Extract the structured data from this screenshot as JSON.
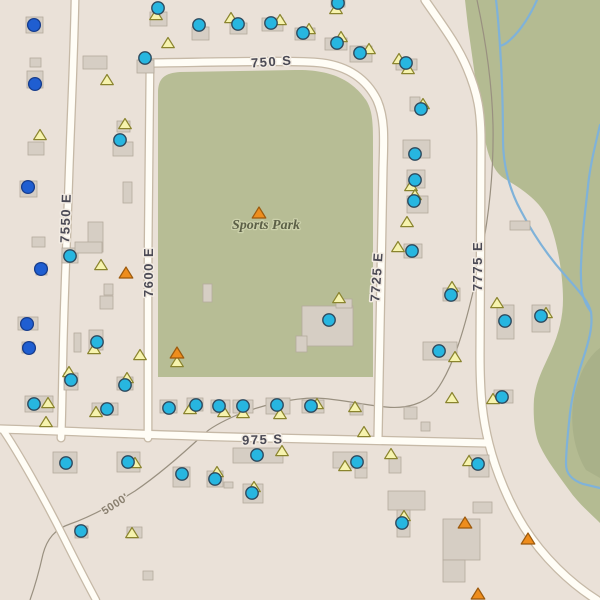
{
  "map_title": "Sports Park area topographic web map",
  "colors": {
    "land": "#eae1d8",
    "veg_green": "#b4bb92",
    "veg_dark": "#a9b189",
    "park_green": "#b7bd95",
    "road_fill": "#fffdf6",
    "road_edge": "#c6b9a7",
    "building_fill": "#d6cec4",
    "building_edge": "#b4aa9d",
    "stream": "#7fb2d9",
    "contour": "#999080",
    "marker_cyan": "#27b6e0",
    "marker_cyan_edge": "#2e4a5e",
    "marker_blue": "#1f5ed1",
    "marker_blue_edge": "#163c8c",
    "tri_yellow": "#f6f3ae",
    "tri_yellow_edge": "#8a842e",
    "tri_orange": "#ee8d1d",
    "tri_orange_edge": "#9c5a0e"
  },
  "labels": {
    "s750": {
      "text": "750 S",
      "transform": "translate(272,66) rotate(-4)"
    },
    "s975": {
      "text": "975 S",
      "transform": "translate(263,444) rotate(-2)"
    },
    "e7550": {
      "text": "7550 E",
      "transform": "translate(70,218) rotate(-88)"
    },
    "e7600": {
      "text": "7600 E",
      "transform": "translate(153,272) rotate(-90)"
    },
    "e7725": {
      "text": "7725 E",
      "transform": "translate(381,277) rotate(-86)"
    },
    "e7775": {
      "text": "7775 E",
      "transform": "translate(482,266) rotate(-90)"
    },
    "park": {
      "text": "Sports Park",
      "transform": "translate(266,229)"
    },
    "contour": {
      "text": "5000'",
      "transform": "translate(117,507) rotate(-33)"
    }
  },
  "geometry": {
    "vegetation": [
      "M465,0 L600,0 L600,523 C591,514 578,503 569,490 C559,476 547,461 540,446 C534,434 533,414 534,399 C536,381 543,369 551,351 C559,333 563,317 563,299 C563,274 557,239 548,219 C540,201 522,189 505,179 C495,173 488,159 484,134 C479,107 472,54 468,27 L465,0 Z"
    ],
    "veg_dark_patch": "M600,348 C586,358 576,380 573,404 C570,430 576,454 586,470 L600,478 Z",
    "park": "M158,377 L158,93 C158,78 165,73 180,72 L295,70 C336,69 355,84 366,100 C373,111 373,124 373,148 L373,377 Z",
    "contour": "M477,0 C486,42 492,82 493,125 C494,178 488,232 473,292 C464,330 453,368 436,391 C424,404 406,409 386,407 C362,405 341,399 316,398 C292,398 262,405 237,415 C221,422 210,428 204,434 C189,448 160,474 135,491 C114,504 90,517 70,524 C55,529 47,539 43,554 C39,572 35,586 30,600",
    "streams": [
      "M496,0 C498,16 499,31 500,46 C502,76 503,106 503,140 C503,166 510,191 521,211 C533,234 549,257 564,274 C577,289 588,300 591,312 C593,326 589,341 583,359 C577,377 572,396 570,413 C568,432 566,450 566,464 C566,474 572,480 583,484 L600,488",
      "M537,0 C531,14 521,30 511,39 C506,44 503,45 500,46",
      "M600,125 C595,146 590,166 588,186 C586,206 583,226 582,246 C581,263 580,276 582,292 C584,301 587,306 591,312"
    ],
    "roads": [
      {
        "name": "road-750-s",
        "d": "M150,63 C225,62 298,60 322,63 C352,67 368,82 377,100 C385,118 384,138 383,168 L378,437",
        "w": 7
      },
      {
        "name": "road-7775-e",
        "d": "M425,0 C440,22 457,44 467,68 C478,94 481,112 481,142 L480,355 C480,398 483,420 489,444 C496,472 509,503 524,527 C543,557 570,583 597,600",
        "w": 7
      },
      {
        "name": "road-7550-e",
        "d": "M75,0 C74,55 71,115 69,175 C67,235 64,300 63,355 C62,395 62,418 61,438",
        "w": 6.5
      },
      {
        "name": "road-7600-e",
        "d": "M150,63 C150,125 148,210 148,290 L148,438",
        "w": 6.5
      },
      {
        "name": "road-975-s",
        "d": "M0,429 C70,431 170,436 270,438 C350,440 420,441 487,443",
        "w": 7
      },
      {
        "name": "road-southwest",
        "d": "M3,430 C18,452 44,498 64,538 C79,568 89,587 96,600",
        "w": 6
      }
    ]
  },
  "buildings": [
    [
      26,
      17,
      17,
      16
    ],
    [
      30,
      58,
      11,
      9
    ],
    [
      27,
      71,
      16,
      17
    ],
    [
      83,
      56,
      24,
      13
    ],
    [
      28,
      142,
      16,
      13
    ],
    [
      20,
      181,
      17,
      16
    ],
    [
      32,
      237,
      13,
      10
    ],
    [
      62,
      248,
      16,
      15
    ],
    [
      36,
      264,
      11,
      11
    ],
    [
      88,
      222,
      15,
      30
    ],
    [
      75,
      242,
      27,
      11
    ],
    [
      123,
      182,
      9,
      21
    ],
    [
      113,
      142,
      20,
      14
    ],
    [
      117,
      121,
      13,
      11
    ],
    [
      104,
      284,
      9,
      11
    ],
    [
      100,
      296,
      13,
      13
    ],
    [
      203,
      284,
      9,
      18
    ],
    [
      150,
      12,
      17,
      14
    ],
    [
      192,
      27,
      17,
      13
    ],
    [
      137,
      60,
      17,
      13
    ],
    [
      230,
      23,
      17,
      11
    ],
    [
      262,
      18,
      21,
      13
    ],
    [
      295,
      28,
      20,
      12
    ],
    [
      325,
      38,
      22,
      12
    ],
    [
      350,
      46,
      22,
      16
    ],
    [
      396,
      59,
      21,
      11
    ],
    [
      331,
      0,
      14,
      7
    ],
    [
      410,
      97,
      10,
      14
    ],
    [
      403,
      140,
      27,
      18
    ],
    [
      407,
      170,
      18,
      18
    ],
    [
      407,
      196,
      21,
      17
    ],
    [
      404,
      244,
      18,
      14
    ],
    [
      443,
      288,
      17,
      13
    ],
    [
      510,
      221,
      20,
      9
    ],
    [
      497,
      305,
      17,
      34
    ],
    [
      532,
      305,
      18,
      27
    ],
    [
      423,
      342,
      34,
      18
    ],
    [
      494,
      390,
      19,
      13
    ],
    [
      302,
      306,
      51,
      40
    ],
    [
      296,
      336,
      11,
      16
    ],
    [
      336,
      299,
      16,
      9
    ],
    [
      18,
      317,
      20,
      13
    ],
    [
      22,
      342,
      12,
      11
    ],
    [
      74,
      333,
      7,
      19
    ],
    [
      89,
      330,
      14,
      20
    ],
    [
      64,
      373,
      14,
      17
    ],
    [
      117,
      377,
      16,
      13
    ],
    [
      25,
      396,
      28,
      16
    ],
    [
      92,
      403,
      26,
      12
    ],
    [
      160,
      400,
      17,
      13
    ],
    [
      187,
      398,
      16,
      13
    ],
    [
      211,
      400,
      19,
      13
    ],
    [
      233,
      400,
      20,
      13
    ],
    [
      266,
      398,
      24,
      16
    ],
    [
      302,
      400,
      22,
      13
    ],
    [
      350,
      404,
      13,
      11
    ],
    [
      404,
      407,
      13,
      12
    ],
    [
      421,
      422,
      9,
      9
    ],
    [
      53,
      452,
      24,
      21
    ],
    [
      117,
      452,
      23,
      20
    ],
    [
      233,
      448,
      50,
      15
    ],
    [
      173,
      467,
      17,
      20
    ],
    [
      207,
      471,
      16,
      16
    ],
    [
      224,
      482,
      9,
      6
    ],
    [
      243,
      484,
      20,
      19
    ],
    [
      75,
      526,
      13,
      12
    ],
    [
      127,
      527,
      15,
      11
    ],
    [
      143,
      571,
      10,
      9
    ],
    [
      333,
      452,
      34,
      16
    ],
    [
      355,
      468,
      12,
      10
    ],
    [
      389,
      457,
      12,
      16
    ],
    [
      469,
      455,
      20,
      22
    ],
    [
      388,
      491,
      37,
      19
    ],
    [
      397,
      510,
      13,
      27
    ],
    [
      473,
      502,
      19,
      11
    ],
    [
      443,
      519,
      37,
      41
    ],
    [
      443,
      560,
      22,
      22
    ]
  ],
  "markers": {
    "cyan_points": [
      [
        158,
        8
      ],
      [
        199,
        25
      ],
      [
        238,
        24
      ],
      [
        271,
        23
      ],
      [
        145,
        58
      ],
      [
        303,
        33
      ],
      [
        338,
        3
      ],
      [
        337,
        43
      ],
      [
        360,
        53
      ],
      [
        406,
        63
      ],
      [
        421,
        109
      ],
      [
        415,
        154
      ],
      [
        415,
        180
      ],
      [
        414,
        201
      ],
      [
        412,
        251
      ],
      [
        451,
        295
      ],
      [
        120,
        140
      ],
      [
        70,
        256
      ],
      [
        329,
        320
      ],
      [
        505,
        321
      ],
      [
        541,
        316
      ],
      [
        439,
        351
      ],
      [
        502,
        397
      ],
      [
        97,
        342
      ],
      [
        71,
        380
      ],
      [
        125,
        385
      ],
      [
        34,
        404
      ],
      [
        107,
        409
      ],
      [
        169,
        408
      ],
      [
        196,
        405
      ],
      [
        219,
        406
      ],
      [
        243,
        406
      ],
      [
        277,
        405
      ],
      [
        311,
        406
      ],
      [
        66,
        463
      ],
      [
        128,
        462
      ],
      [
        257,
        455
      ],
      [
        182,
        474
      ],
      [
        215,
        479
      ],
      [
        252,
        493
      ],
      [
        81,
        531
      ],
      [
        402,
        523
      ],
      [
        357,
        462
      ],
      [
        478,
        464
      ]
    ],
    "blue_points": [
      [
        34,
        25
      ],
      [
        35,
        84
      ],
      [
        28,
        187
      ],
      [
        41,
        269
      ],
      [
        27,
        324
      ],
      [
        29,
        348
      ]
    ],
    "yellow_triangles": [
      [
        156,
        15
      ],
      [
        231,
        18
      ],
      [
        280,
        20
      ],
      [
        168,
        43
      ],
      [
        309,
        29
      ],
      [
        336,
        9
      ],
      [
        341,
        37
      ],
      [
        369,
        49
      ],
      [
        399,
        59
      ],
      [
        408,
        69
      ],
      [
        423,
        104
      ],
      [
        411,
        186
      ],
      [
        415,
        195
      ],
      [
        398,
        247
      ],
      [
        452,
        287
      ],
      [
        125,
        124
      ],
      [
        107,
        80
      ],
      [
        40,
        135
      ],
      [
        101,
        265
      ],
      [
        497,
        303
      ],
      [
        546,
        313
      ],
      [
        455,
        357
      ],
      [
        493,
        399
      ],
      [
        94,
        349
      ],
      [
        69,
        372
      ],
      [
        127,
        378
      ],
      [
        48,
        403
      ],
      [
        96,
        412
      ],
      [
        190,
        409
      ],
      [
        224,
        412
      ],
      [
        243,
        413
      ],
      [
        280,
        414
      ],
      [
        317,
        404
      ],
      [
        355,
        407
      ],
      [
        140,
        355
      ],
      [
        177,
        362
      ],
      [
        46,
        422
      ],
      [
        339,
        298
      ],
      [
        364,
        432
      ],
      [
        391,
        454
      ],
      [
        452,
        398
      ],
      [
        469,
        461
      ],
      [
        345,
        466
      ],
      [
        282,
        451
      ],
      [
        217,
        472
      ],
      [
        254,
        487
      ],
      [
        132,
        533
      ],
      [
        404,
        516
      ],
      [
        407,
        222
      ],
      [
        135,
        463
      ]
    ],
    "orange_triangles": [
      [
        259,
        213
      ],
      [
        126,
        273
      ],
      [
        177,
        353
      ],
      [
        465,
        523
      ],
      [
        528,
        539
      ],
      [
        478,
        594
      ]
    ]
  }
}
